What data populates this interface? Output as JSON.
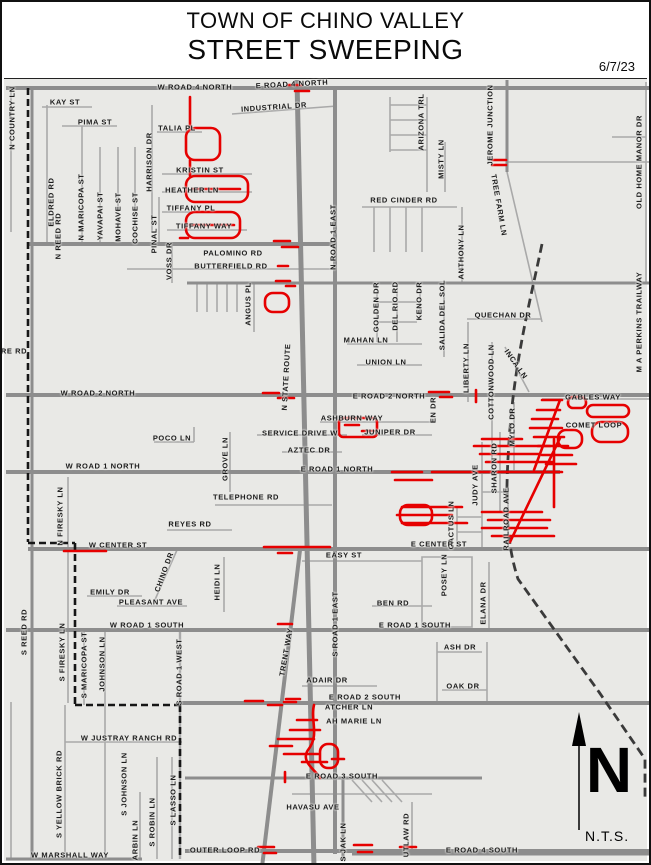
{
  "header": {
    "title_line1": "TOWN OF CHINO VALLEY",
    "title_line2": "STREET SWEEPING",
    "date": "6/7/23"
  },
  "compass": {
    "letter": "N",
    "scale_note": "N.T.S."
  },
  "colors": {
    "sweep_route_red": "#e60000",
    "road_major_gray": "#8d8d8d",
    "road_minor_gray": "#a9a9a9",
    "map_background": "#e9e9e6",
    "boundary_black": "#161616"
  },
  "map": {
    "street_labels": [
      {
        "t": "W ROAD 4 NORTH",
        "x": 193,
        "y": 85,
        "o": "h"
      },
      {
        "t": "E ROAD 4 NORTH",
        "x": 290,
        "y": 82,
        "o": "d",
        "r": -3
      },
      {
        "t": "KAY ST",
        "x": 63,
        "y": 100,
        "o": "h"
      },
      {
        "t": "PIMA ST",
        "x": 93,
        "y": 120,
        "o": "h"
      },
      {
        "t": "INDUSTRIAL DR",
        "x": 272,
        "y": 105,
        "o": "d",
        "r": -4
      },
      {
        "t": "TALIA PL",
        "x": 175,
        "y": 126,
        "o": "h"
      },
      {
        "t": "KRISTIN ST",
        "x": 198,
        "y": 168,
        "o": "h"
      },
      {
        "t": "HEATHER LN",
        "x": 190,
        "y": 188,
        "o": "h"
      },
      {
        "t": "TIFFANY PL",
        "x": 189,
        "y": 206,
        "o": "h"
      },
      {
        "t": "TIFFANY WAY",
        "x": 202,
        "y": 224,
        "o": "h"
      },
      {
        "t": "N COUNTRY LN",
        "x": 10,
        "y": 116,
        "o": "v"
      },
      {
        "t": "N REED RD",
        "x": 56,
        "y": 234,
        "o": "v"
      },
      {
        "t": "ELDRED RD",
        "x": 49,
        "y": 200,
        "o": "v"
      },
      {
        "t": "N MARICOPA ST",
        "x": 79,
        "y": 205,
        "o": "v"
      },
      {
        "t": "YAVAPAI ST",
        "x": 98,
        "y": 214,
        "o": "v"
      },
      {
        "t": "MOHAVE ST",
        "x": 116,
        "y": 215,
        "o": "v"
      },
      {
        "t": "COCHISE ST",
        "x": 133,
        "y": 216,
        "o": "v"
      },
      {
        "t": "HARRISON DR",
        "x": 147,
        "y": 160,
        "o": "v"
      },
      {
        "t": "PINAL ST",
        "x": 152,
        "y": 232,
        "o": "v"
      },
      {
        "t": "VOSS DR",
        "x": 167,
        "y": 259,
        "o": "v"
      },
      {
        "t": "ARIZONA TRL",
        "x": 419,
        "y": 120,
        "o": "v"
      },
      {
        "t": "MISTY LN",
        "x": 439,
        "y": 157,
        "o": "v"
      },
      {
        "t": "JEROME JUNCTION",
        "x": 488,
        "y": 123,
        "o": "v"
      },
      {
        "t": "TREE FARM LN",
        "x": 497,
        "y": 203,
        "o": "d",
        "r": 80
      },
      {
        "t": "OLD HOME MANOR DR",
        "x": 637,
        "y": 160,
        "o": "v"
      },
      {
        "t": "M A PERKINS TRAILWAY",
        "x": 637,
        "y": 320,
        "o": "v"
      },
      {
        "t": "RED CINDER RD",
        "x": 402,
        "y": 198,
        "o": "h"
      },
      {
        "t": "N ROAD 1 EAST",
        "x": 331,
        "y": 235,
        "o": "v"
      },
      {
        "t": "ANTHONY LN",
        "x": 459,
        "y": 250,
        "o": "v"
      },
      {
        "t": "PALOMINO RD",
        "x": 231,
        "y": 251,
        "o": "h"
      },
      {
        "t": "BUTTERFIELD RD",
        "x": 229,
        "y": 264,
        "o": "h"
      },
      {
        "t": "ANGUS PL",
        "x": 246,
        "y": 302,
        "o": "v"
      },
      {
        "t": "N STATE ROUTE",
        "x": 284,
        "y": 375,
        "o": "d",
        "r": -87
      },
      {
        "t": "GOLDEN DR",
        "x": 374,
        "y": 305,
        "o": "v"
      },
      {
        "t": "DEL RIO RD",
        "x": 393,
        "y": 304,
        "o": "v"
      },
      {
        "t": "KENO DR",
        "x": 417,
        "y": 299,
        "o": "v"
      },
      {
        "t": "SALIDA DEL SOL",
        "x": 440,
        "y": 313,
        "o": "v"
      },
      {
        "t": "LIBERTY LN",
        "x": 464,
        "y": 366,
        "o": "v"
      },
      {
        "t": "QUECHAN DR",
        "x": 501,
        "y": 313,
        "o": "h"
      },
      {
        "t": "COTTONWOOD LN",
        "x": 489,
        "y": 380,
        "o": "v"
      },
      {
        "t": "INCA LN",
        "x": 514,
        "y": 362,
        "o": "d",
        "r": 55
      },
      {
        "t": "MYLO DR",
        "x": 510,
        "y": 425,
        "o": "v"
      },
      {
        "t": "GABLES WAY",
        "x": 591,
        "y": 395,
        "o": "h"
      },
      {
        "t": "COMET LOOP",
        "x": 592,
        "y": 423,
        "o": "h"
      },
      {
        "t": "MAHAN LN",
        "x": 364,
        "y": 338,
        "o": "h"
      },
      {
        "t": "UNION LN",
        "x": 384,
        "y": 360,
        "o": "h"
      },
      {
        "t": "W ROAD 2 NORTH",
        "x": 96,
        "y": 391,
        "o": "h"
      },
      {
        "t": "E ROAD 2 NORTH",
        "x": 387,
        "y": 394,
        "o": "h"
      },
      {
        "t": "ASHBURN WAY",
        "x": 350,
        "y": 416,
        "o": "h"
      },
      {
        "t": "SERVICE DRIVE W",
        "x": 298,
        "y": 431,
        "o": "h"
      },
      {
        "t": "JUNIPER DR",
        "x": 388,
        "y": 430,
        "o": "h"
      },
      {
        "t": "AZTEC DR",
        "x": 307,
        "y": 448,
        "o": "h"
      },
      {
        "t": "POCO LN",
        "x": 170,
        "y": 436,
        "o": "h"
      },
      {
        "t": "W ROAD 1 NORTH",
        "x": 101,
        "y": 464,
        "o": "h"
      },
      {
        "t": "E ROAD 1 NORTH",
        "x": 335,
        "y": 467,
        "o": "h"
      },
      {
        "t": "GROVE LN",
        "x": 223,
        "y": 457,
        "o": "v"
      },
      {
        "t": "TELEPHONE RD",
        "x": 244,
        "y": 495,
        "o": "h"
      },
      {
        "t": "REYES RD",
        "x": 188,
        "y": 522,
        "o": "h"
      },
      {
        "t": "N FIRESKY LN",
        "x": 58,
        "y": 514,
        "o": "v"
      },
      {
        "t": "EN DR",
        "x": 431,
        "y": 408,
        "o": "v"
      },
      {
        "t": "JUDY AVE",
        "x": 473,
        "y": 483,
        "o": "v"
      },
      {
        "t": "SHARON RD",
        "x": 492,
        "y": 466,
        "o": "v"
      },
      {
        "t": "CACTUS LN",
        "x": 449,
        "y": 523,
        "o": "v"
      },
      {
        "t": "RAILROAD AVE",
        "x": 504,
        "y": 517,
        "o": "v"
      },
      {
        "t": "W CENTER ST",
        "x": 116,
        "y": 543,
        "o": "h"
      },
      {
        "t": "E CENTER ST",
        "x": 437,
        "y": 542,
        "o": "h"
      },
      {
        "t": "EASY ST",
        "x": 342,
        "y": 553,
        "o": "h"
      },
      {
        "t": "CHINO DR",
        "x": 162,
        "y": 570,
        "o": "d",
        "r": -70
      },
      {
        "t": "HEIDI LN",
        "x": 215,
        "y": 580,
        "o": "v"
      },
      {
        "t": "EMILY DR",
        "x": 108,
        "y": 590,
        "o": "h"
      },
      {
        "t": "PLEASANT AVE",
        "x": 149,
        "y": 600,
        "o": "h"
      },
      {
        "t": "W ROAD 1 SOUTH",
        "x": 145,
        "y": 623,
        "o": "h"
      },
      {
        "t": "E ROAD 1 SOUTH",
        "x": 413,
        "y": 623,
        "o": "h"
      },
      {
        "t": "BEN RD",
        "x": 391,
        "y": 601,
        "o": "h"
      },
      {
        "t": "POSEY LN",
        "x": 442,
        "y": 573,
        "o": "v"
      },
      {
        "t": "ELANA DR",
        "x": 481,
        "y": 601,
        "o": "v"
      },
      {
        "t": "ASH DR",
        "x": 458,
        "y": 645,
        "o": "h"
      },
      {
        "t": "OAK DR",
        "x": 461,
        "y": 684,
        "o": "h"
      },
      {
        "t": "S REED RD",
        "x": 22,
        "y": 630,
        "o": "v"
      },
      {
        "t": "S FIRESKY LN",
        "x": 60,
        "y": 650,
        "o": "v"
      },
      {
        "t": "S MARICOPA ST",
        "x": 82,
        "y": 663,
        "o": "v"
      },
      {
        "t": "JOHNSON LN",
        "x": 100,
        "y": 662,
        "o": "v"
      },
      {
        "t": "S ROAD 1 WEST",
        "x": 177,
        "y": 670,
        "o": "v"
      },
      {
        "t": "TRENT WAY",
        "x": 284,
        "y": 650,
        "o": "d",
        "r": -80
      },
      {
        "t": "S ROAD 1 EAST",
        "x": 333,
        "y": 622,
        "o": "v"
      },
      {
        "t": "ADAIR DR",
        "x": 325,
        "y": 678,
        "o": "h"
      },
      {
        "t": "E ROAD 2 SOUTH",
        "x": 363,
        "y": 695,
        "o": "h"
      },
      {
        "t": "ATCHER LN",
        "x": 347,
        "y": 705,
        "o": "h"
      },
      {
        "t": "AH MARIE LN",
        "x": 352,
        "y": 719,
        "o": "h"
      },
      {
        "t": "W JUSTRAY RANCH RD",
        "x": 127,
        "y": 736,
        "o": "h"
      },
      {
        "t": "S YELLOW BRICK RD",
        "x": 57,
        "y": 792,
        "o": "v"
      },
      {
        "t": "S JOHNSON LN",
        "x": 122,
        "y": 782,
        "o": "v"
      },
      {
        "t": "ARBIN LN",
        "x": 133,
        "y": 838,
        "o": "v"
      },
      {
        "t": "S ROBIN LN",
        "x": 150,
        "y": 820,
        "o": "v"
      },
      {
        "t": "S LASSO LN",
        "x": 171,
        "y": 798,
        "o": "v"
      },
      {
        "t": "OUTER LOOP RD",
        "x": 223,
        "y": 848,
        "o": "h"
      },
      {
        "t": "W MARSHALL WAY",
        "x": 68,
        "y": 853,
        "o": "h"
      },
      {
        "t": "HAVASU AVE",
        "x": 311,
        "y": 805,
        "o": "h"
      },
      {
        "t": "E ROAD 3 SOUTH",
        "x": 340,
        "y": 774,
        "o": "h"
      },
      {
        "t": "S JAK LN",
        "x": 341,
        "y": 840,
        "o": "v"
      },
      {
        "t": "UTLAW RD",
        "x": 404,
        "y": 833,
        "o": "v"
      },
      {
        "t": "E ROAD 4 SOUTH",
        "x": 480,
        "y": 848,
        "o": "h"
      },
      {
        "t": "RE RD",
        "x": 12,
        "y": 349,
        "o": "h"
      }
    ]
  }
}
